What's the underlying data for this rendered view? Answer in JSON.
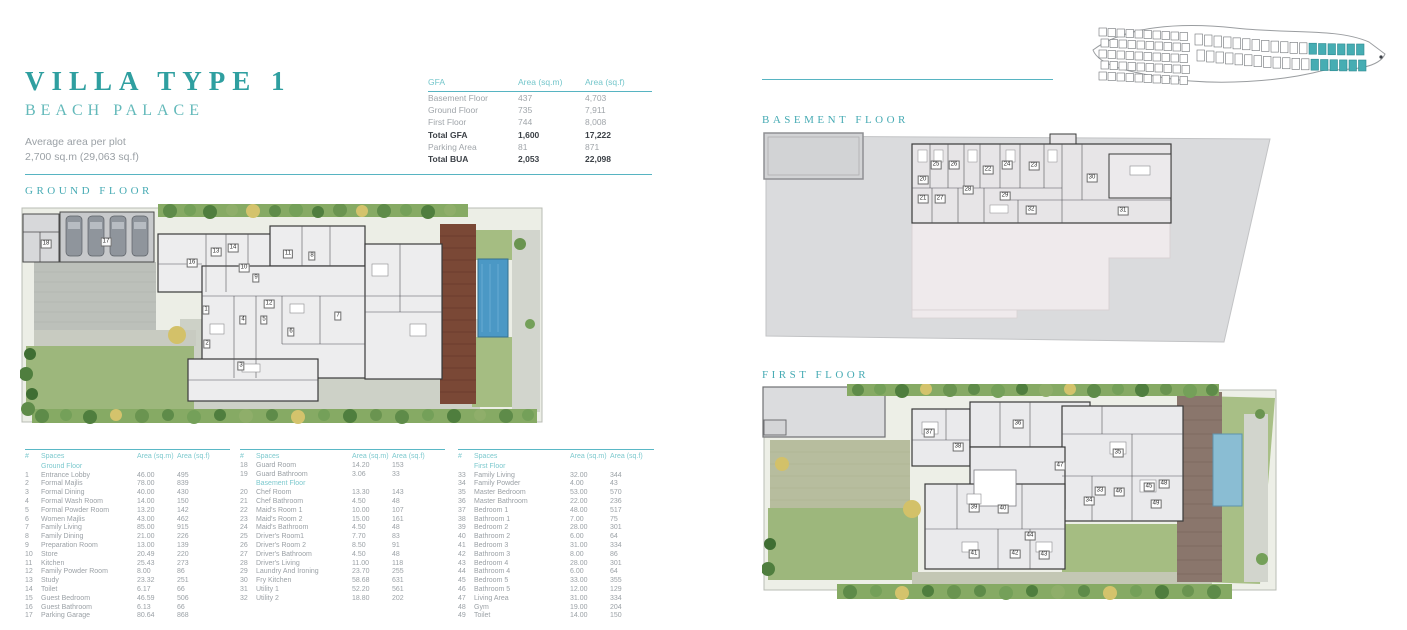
{
  "header": {
    "title": "VILLA TYPE 1",
    "subtitle": "BEACH PALACE",
    "avg_label": "Average area per plot",
    "avg_value": "2,700 sq.m (29,063 sq.f)"
  },
  "gfa_table": {
    "columns": [
      "GFA",
      "Area (sq.m)",
      "Area (sq.f)"
    ],
    "rows": [
      {
        "label": "Basement Floor",
        "sqm": "437",
        "sqf": "4,703",
        "bold": false
      },
      {
        "label": "Ground Floor",
        "sqm": "735",
        "sqf": "7,911",
        "bold": false
      },
      {
        "label": "First Floor",
        "sqm": "744",
        "sqf": "8,008",
        "bold": false
      },
      {
        "label": "Total GFA",
        "sqm": "1,600",
        "sqf": "17,222",
        "bold": true
      },
      {
        "label": "Parking Area",
        "sqm": "81",
        "sqf": "871",
        "bold": false
      },
      {
        "label": "Total BUA",
        "sqm": "2,053",
        "sqf": "22,098",
        "bold": true
      }
    ]
  },
  "sections": {
    "ground": "GROUND FLOOR",
    "basement": "BASEMENT FLOOR",
    "first": "FIRST FLOOR"
  },
  "space_tables": [
    {
      "columns": [
        "#",
        "Spaces",
        "Area (sq.m)",
        "Area (sq.f)"
      ],
      "sections": [
        {
          "heading": "Ground Floor",
          "rows": [
            [
              "1",
              "Entrance Lobby",
              "46.00",
              "495"
            ],
            [
              "2",
              "Formal Majlis",
              "78.00",
              "839"
            ],
            [
              "3",
              "Formal Dining",
              "40.00",
              "430"
            ],
            [
              "4",
              "Formal Wash Room",
              "14.00",
              "150"
            ],
            [
              "5",
              "Formal Powder Room",
              "13.20",
              "142"
            ],
            [
              "6",
              "Women Majlis",
              "43.00",
              "462"
            ],
            [
              "7",
              "Family Living",
              "85.00",
              "915"
            ],
            [
              "8",
              "Family Dining",
              "21.00",
              "226"
            ],
            [
              "9",
              "Preparation Room",
              "13.00",
              "139"
            ],
            [
              "10",
              "Store",
              "20.49",
              "220"
            ],
            [
              "11",
              "Kitchen",
              "25.43",
              "273"
            ],
            [
              "12",
              "Family Powder Room",
              "8.00",
              "86"
            ],
            [
              "13",
              "Study",
              "23.32",
              "251"
            ],
            [
              "14",
              "Toilet",
              "6.17",
              "66"
            ],
            [
              "15",
              "Guest Bedroom",
              "46.59",
              "506"
            ],
            [
              "16",
              "Guest Bathroom",
              "6.13",
              "66"
            ],
            [
              "17",
              "Parking Garage",
              "80.64",
              "868"
            ]
          ]
        }
      ]
    },
    {
      "columns": [
        "#",
        "Spaces",
        "Area (sq.m)",
        "Area (sq.f)"
      ],
      "sections": [
        {
          "heading": null,
          "rows": [
            [
              "18",
              "Guard Room",
              "14.20",
              "153"
            ],
            [
              "19",
              "Guard Bathroom",
              "3.06",
              "33"
            ]
          ]
        },
        {
          "heading": "Basement Floor",
          "rows": [
            [
              "20",
              "Chef Room",
              "13.30",
              "143"
            ],
            [
              "21",
              "Chef Bathroom",
              "4.50",
              "48"
            ],
            [
              "22",
              "Maid's Room 1",
              "10.00",
              "107"
            ],
            [
              "23",
              "Maid's Room 2",
              "15.00",
              "161"
            ],
            [
              "24",
              "Maid's Bathroom",
              "4.50",
              "48"
            ],
            [
              "25",
              "Driver's Room1",
              "7.70",
              "83"
            ],
            [
              "26",
              "Driver's Room 2",
              "8.50",
              "91"
            ],
            [
              "27",
              "Driver's Bathroom",
              "4.50",
              "48"
            ],
            [
              "28",
              "Driver's Living",
              "11.00",
              "118"
            ],
            [
              "29",
              "Laundry And Ironing",
              "23.70",
              "255"
            ],
            [
              "30",
              "Fry Kitchen",
              "58.68",
              "631"
            ],
            [
              "31",
              "Utility 1",
              "52.20",
              "561"
            ],
            [
              "32",
              "Utility 2",
              "18.80",
              "202"
            ]
          ]
        }
      ]
    },
    {
      "columns": [
        "#",
        "Spaces",
        "Area (sq.m)",
        "Area (sq.f)"
      ],
      "sections": [
        {
          "heading": "First Floor",
          "rows": [
            [
              "33",
              "Family Living",
              "32.00",
              "344"
            ],
            [
              "34",
              "Family Powder",
              "4.00",
              "43"
            ],
            [
              "35",
              "Master Bedroom",
              "53.00",
              "570"
            ],
            [
              "36",
              "Master Bathroom",
              "22.00",
              "236"
            ],
            [
              "37",
              "Bedroom 1",
              "48.00",
              "517"
            ],
            [
              "38",
              "Bathroom 1",
              "7.00",
              "75"
            ],
            [
              "39",
              "Bedroom 2",
              "28.00",
              "301"
            ],
            [
              "40",
              "Bathroom 2",
              "6.00",
              "64"
            ],
            [
              "41",
              "Bedroom 3",
              "31.00",
              "334"
            ],
            [
              "42",
              "Bathroom 3",
              "8.00",
              "86"
            ],
            [
              "43",
              "Bedroom 4",
              "28.00",
              "301"
            ],
            [
              "44",
              "Bathroom 4",
              "6.00",
              "64"
            ],
            [
              "45",
              "Bedroom 5",
              "33.00",
              "355"
            ],
            [
              "46",
              "Bathroom 5",
              "12.00",
              "129"
            ],
            [
              "47",
              "Living Area",
              "31.00",
              "334"
            ],
            [
              "48",
              "Gym",
              "19.00",
              "204"
            ],
            [
              "49",
              "Toilet",
              "14.00",
              "150"
            ]
          ]
        }
      ]
    }
  ],
  "plans": {
    "ground": {
      "labels": [
        {
          "n": "17",
          "x": 86,
          "y": 38
        },
        {
          "n": "18",
          "x": 26,
          "y": 40
        },
        {
          "n": "16",
          "x": 172,
          "y": 59
        },
        {
          "n": "13",
          "x": 196,
          "y": 48
        },
        {
          "n": "14",
          "x": 213,
          "y": 44
        },
        {
          "n": "10",
          "x": 224,
          "y": 64
        },
        {
          "n": "11",
          "x": 268,
          "y": 50
        },
        {
          "n": "8",
          "x": 292,
          "y": 52
        },
        {
          "n": "9",
          "x": 236,
          "y": 74
        },
        {
          "n": "12",
          "x": 249,
          "y": 100
        },
        {
          "n": "1",
          "x": 186,
          "y": 106
        },
        {
          "n": "4",
          "x": 223,
          "y": 116
        },
        {
          "n": "5",
          "x": 244,
          "y": 116
        },
        {
          "n": "6",
          "x": 271,
          "y": 128
        },
        {
          "n": "7",
          "x": 318,
          "y": 112
        },
        {
          "n": "2",
          "x": 187,
          "y": 140
        },
        {
          "n": "3",
          "x": 221,
          "y": 162
        }
      ]
    },
    "basement": {
      "labels": [
        {
          "n": "20",
          "x": 161,
          "y": 50
        },
        {
          "n": "25",
          "x": 174,
          "y": 35
        },
        {
          "n": "26",
          "x": 192,
          "y": 35
        },
        {
          "n": "22",
          "x": 226,
          "y": 40
        },
        {
          "n": "24",
          "x": 245,
          "y": 35
        },
        {
          "n": "23",
          "x": 272,
          "y": 36
        },
        {
          "n": "21",
          "x": 161,
          "y": 69
        },
        {
          "n": "27",
          "x": 178,
          "y": 69
        },
        {
          "n": "28",
          "x": 206,
          "y": 60
        },
        {
          "n": "29",
          "x": 243,
          "y": 66
        },
        {
          "n": "32",
          "x": 269,
          "y": 80
        },
        {
          "n": "30",
          "x": 330,
          "y": 48
        },
        {
          "n": "31",
          "x": 361,
          "y": 81
        }
      ]
    },
    "first": {
      "labels": [
        {
          "n": "37",
          "x": 167,
          "y": 49
        },
        {
          "n": "36",
          "x": 256,
          "y": 40
        },
        {
          "n": "38",
          "x": 196,
          "y": 63
        },
        {
          "n": "47",
          "x": 298,
          "y": 82
        },
        {
          "n": "35",
          "x": 356,
          "y": 69
        },
        {
          "n": "45",
          "x": 387,
          "y": 103
        },
        {
          "n": "33",
          "x": 338,
          "y": 107
        },
        {
          "n": "46",
          "x": 357,
          "y": 108
        },
        {
          "n": "34",
          "x": 327,
          "y": 117
        },
        {
          "n": "40",
          "x": 241,
          "y": 125
        },
        {
          "n": "39",
          "x": 212,
          "y": 124
        },
        {
          "n": "44",
          "x": 268,
          "y": 152
        },
        {
          "n": "41",
          "x": 212,
          "y": 170
        },
        {
          "n": "42",
          "x": 253,
          "y": 170
        },
        {
          "n": "43",
          "x": 282,
          "y": 171
        },
        {
          "n": "48",
          "x": 402,
          "y": 100
        },
        {
          "n": "49",
          "x": 394,
          "y": 120
        }
      ]
    }
  },
  "site_map": {
    "highlight_color": "#46adb3",
    "plot_stroke": "#6f7377"
  },
  "colors": {
    "teal_dark": "#2f9fa0",
    "teal_mid": "#47abb4",
    "teal_light": "#7dc9ce",
    "rule": "#57b4c2",
    "text_gray": "#9ba1a6",
    "text_dark": "#3c4147",
    "lawn": "#9db77c",
    "hedge": "#86aa64",
    "deck_ground": "#7a4836",
    "deck_first": "#8a766c",
    "pool_ground": "#4b98c5",
    "pool_first": "#8abdd3"
  }
}
